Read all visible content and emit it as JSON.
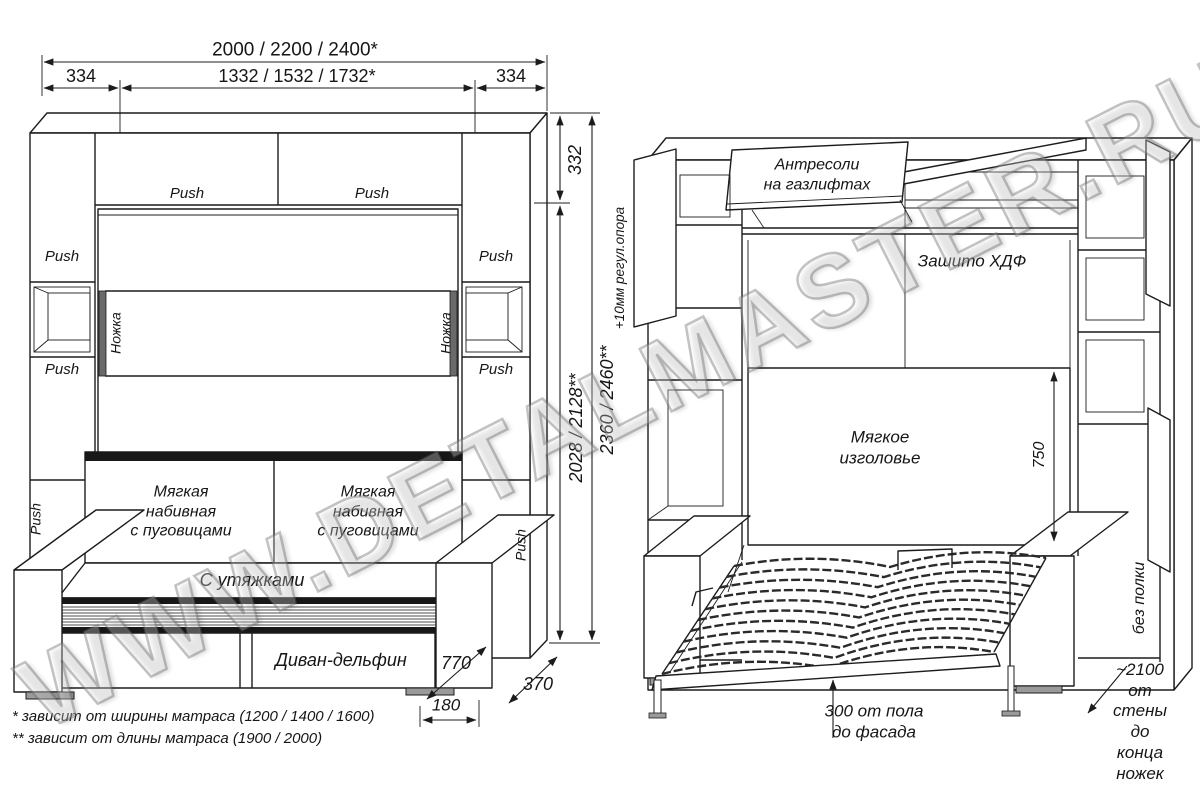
{
  "watermark": {
    "text": "WWW.DETALMASTER.RU"
  },
  "closed_view": {
    "dims": {
      "total_width": "2000 / 2200 / 2400*",
      "side_left": "334",
      "inner_width": "1332 / 1532 / 1732*",
      "side_right": "334",
      "top_section_height": "332",
      "inner_height": "2028 / 2128**",
      "total_height": "2360 / 2460**",
      "support_note": "+10мм регул.опора",
      "sofa_depth": "770",
      "cabinet_depth": "370",
      "plinth_depth": "180"
    },
    "labels": {
      "push": "Push",
      "leg": "Ножка",
      "cushion": "Мягкая\nнабивная\nс пуговицами",
      "seat": "С утяжками",
      "sofa_type": "Диван-дельфин"
    }
  },
  "open_view": {
    "dims": {
      "headboard_height": "750"
    },
    "labels": {
      "antresol": "Антресоли\nна газлифтах",
      "back_panel": "Зашито ХДФ",
      "headboard": "Мягкое\nизголовье",
      "no_shelf": "без полки",
      "floor_clearance": "300 от пола\nдо фасада",
      "wall_to_legs": "~2100\nот стены\nдо конца ножек"
    }
  },
  "footnotes": {
    "width_note": "* зависит от ширины матраса (1200 / 1400 / 1600)",
    "length_note": "** зависит от длины матраса (1900 / 2000)"
  }
}
